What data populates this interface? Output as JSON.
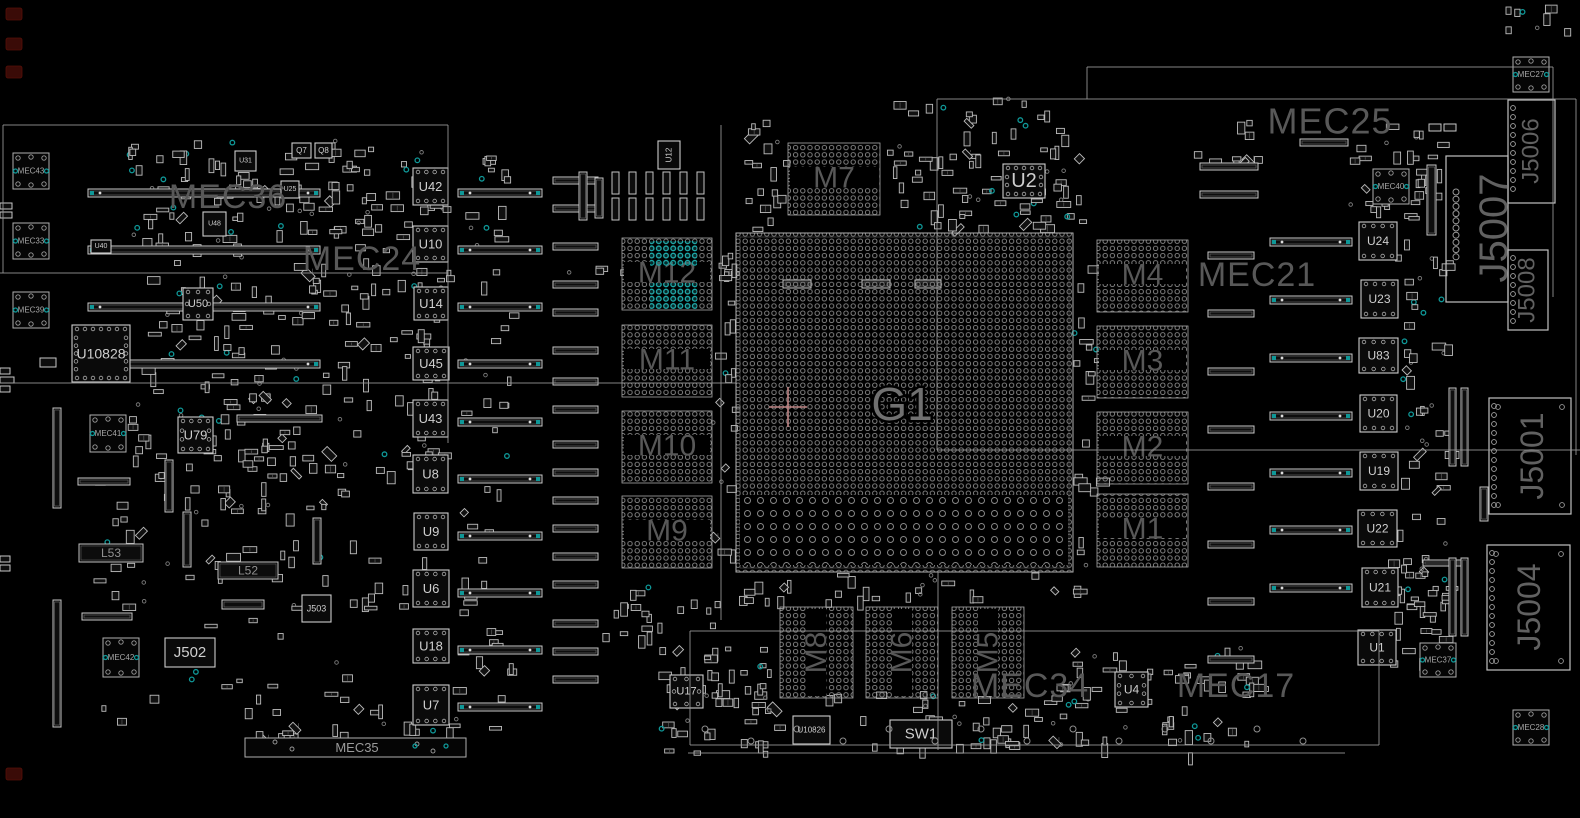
{
  "app": {
    "title": "PCB boardview component placement drawing"
  },
  "board": {
    "width": 1580,
    "height": 818
  },
  "colors": {
    "bg": "#000000",
    "outline": "#9a9a9a",
    "part": "#bdbdbd",
    "part_dim": "#6f6f6f",
    "fill_dark": "#101010",
    "label_big": "#585858",
    "label_g1": "#707070",
    "label_chip": "#cfcfcf",
    "label_fid": "#a8a8a8",
    "teal": "#0f9898",
    "teal_bright": "#14b0b0",
    "pink": "#c08585",
    "hole": "#8f8f8f",
    "maroon": "#3a0b07",
    "dot": "#8c8c8c"
  },
  "region_labels": [
    {
      "text": "MEC36",
      "x": 228,
      "y": 197,
      "size": 34
    },
    {
      "text": "MEC24",
      "x": 362,
      "y": 259,
      "size": 34
    },
    {
      "text": "MEC25",
      "x": 1330,
      "y": 121,
      "size": 36
    },
    {
      "text": "MEC21",
      "x": 1257,
      "y": 275,
      "size": 34
    },
    {
      "text": "MEC17",
      "x": 1236,
      "y": 686,
      "size": 34
    },
    {
      "text": "MEC34",
      "x": 1030,
      "y": 686,
      "size": 34
    }
  ],
  "g1": {
    "label": "G1",
    "x": 736,
    "y": 233,
    "w": 337,
    "h": 339,
    "label_x": 902,
    "label_y": 404,
    "label_size": 46,
    "cross_x": 788,
    "cross_y": 407,
    "sparse": [
      740,
      495,
      328,
      70
    ]
  },
  "memory_blocks": [
    {
      "label": "M12",
      "x": 622,
      "y": 238,
      "w": 90,
      "h": 72
    },
    {
      "label": "M11",
      "x": 622,
      "y": 325,
      "w": 90,
      "h": 72
    },
    {
      "label": "M10",
      "x": 622,
      "y": 411,
      "w": 90,
      "h": 72
    },
    {
      "label": "M9",
      "x": 622,
      "y": 496,
      "w": 90,
      "h": 72
    },
    {
      "label": "M7",
      "x": 788,
      "y": 143,
      "w": 92,
      "h": 72
    },
    {
      "label": "M4",
      "x": 1097,
      "y": 240,
      "w": 91,
      "h": 72
    },
    {
      "label": "M3",
      "x": 1097,
      "y": 326,
      "w": 91,
      "h": 72
    },
    {
      "label": "M2",
      "x": 1097,
      "y": 412,
      "w": 91,
      "h": 72
    },
    {
      "label": "M1",
      "x": 1097,
      "y": 494,
      "w": 91,
      "h": 73
    },
    {
      "label": "M8",
      "x": 780,
      "y": 607,
      "w": 73,
      "h": 91,
      "rot": true
    },
    {
      "label": "M6",
      "x": 866,
      "y": 607,
      "w": 72,
      "h": 91,
      "rot": true
    },
    {
      "label": "M5",
      "x": 952,
      "y": 607,
      "w": 72,
      "h": 91,
      "rot": true
    }
  ],
  "m12_teal_patches": [
    [
      650,
      241,
      47,
      25
    ],
    [
      650,
      283,
      47,
      26
    ]
  ],
  "chips": [
    [
      "U42",
      413,
      168,
      35,
      37,
      "qfn",
      13
    ],
    [
      "U10",
      413,
      226,
      35,
      36,
      "qfn",
      13
    ],
    [
      "U14",
      414,
      287,
      34,
      33,
      "qfn",
      13
    ],
    [
      "U45",
      413,
      347,
      36,
      33,
      "qfn",
      13
    ],
    [
      "U43",
      413,
      400,
      35,
      37,
      "qfn",
      13
    ],
    [
      "U8",
      413,
      455,
      35,
      38,
      "qfn",
      13
    ],
    [
      "U9",
      414,
      513,
      34,
      37,
      "qfn",
      13
    ],
    [
      "U6",
      413,
      570,
      36,
      37,
      "qfn",
      13
    ],
    [
      "U18",
      413,
      629,
      36,
      34,
      "qfn",
      13
    ],
    [
      "U7",
      413,
      685,
      36,
      40,
      "qfn",
      13
    ],
    [
      "U24",
      1359,
      222,
      38,
      38,
      "qfn",
      12
    ],
    [
      "U23",
      1361,
      280,
      37,
      38,
      "qfn",
      12
    ],
    [
      "U83",
      1359,
      338,
      39,
      35,
      "qfn",
      12
    ],
    [
      "U20",
      1360,
      395,
      37,
      37,
      "qfn",
      12
    ],
    [
      "U19",
      1360,
      452,
      38,
      38,
      "qfn",
      12
    ],
    [
      "U22",
      1358,
      510,
      39,
      37,
      "qfn",
      12
    ],
    [
      "U21",
      1362,
      568,
      36,
      39,
      "qfn",
      12
    ],
    [
      "U1",
      1358,
      630,
      38,
      35,
      "qfn",
      12
    ],
    [
      "U10828",
      72,
      325,
      58,
      57,
      "qfn4",
      14
    ],
    [
      "U50",
      183,
      288,
      30,
      32,
      "qfn4",
      11
    ],
    [
      "U79",
      178,
      417,
      35,
      36,
      "qfn4",
      13
    ],
    [
      "U2",
      1003,
      164,
      42,
      34,
      "qfn4",
      20
    ],
    [
      "U17",
      670,
      675,
      33,
      33,
      "qfn4",
      11
    ],
    [
      "U4",
      1115,
      672,
      33,
      35,
      "qfn4",
      12
    ],
    [
      "U12",
      658,
      141,
      22,
      28,
      "box",
      8,
      1
    ],
    [
      "U31",
      235,
      151,
      21,
      20,
      "box",
      7
    ],
    [
      "Q7",
      292,
      143,
      19,
      15,
      "box",
      8
    ],
    [
      "Q8",
      315,
      143,
      17,
      15,
      "box",
      8
    ],
    [
      "U25",
      281,
      181,
      18,
      17,
      "box",
      7
    ],
    [
      "U48",
      203,
      212,
      23,
      24,
      "box",
      7
    ],
    [
      "U40",
      91,
      240,
      20,
      13,
      "box",
      7
    ],
    [
      "U10826",
      793,
      716,
      37,
      28,
      "box",
      8
    ],
    [
      "SW1",
      890,
      720,
      62,
      28,
      "box",
      15
    ],
    [
      "J502",
      165,
      638,
      50,
      29,
      "box",
      15
    ],
    [
      "J503",
      302,
      595,
      29,
      27,
      "box",
      9
    ]
  ],
  "connectors": [
    {
      "label": "J5007",
      "x": 1446,
      "y": 156,
      "w": 62,
      "h": 146,
      "font": 40,
      "lx": 1494,
      "ly": 228,
      "holes": true
    },
    {
      "label": "J5006",
      "x": 1508,
      "y": 100,
      "w": 47,
      "h": 103,
      "font": 24,
      "lx": 1531,
      "ly": 151,
      "bumps": true
    },
    {
      "label": "J5008",
      "x": 1508,
      "y": 250,
      "w": 40,
      "h": 80,
      "font": 24,
      "lx": 1527,
      "ly": 290,
      "bumps": true
    },
    {
      "label": "J5001",
      "x": 1489,
      "y": 398,
      "w": 82,
      "h": 116,
      "font": 32,
      "lx": 1532,
      "ly": 456,
      "bumps": true,
      "corners": true
    },
    {
      "label": "J5004",
      "x": 1487,
      "y": 545,
      "w": 83,
      "h": 125,
      "font": 32,
      "lx": 1529,
      "ly": 607,
      "bumps": true,
      "corners": true
    }
  ],
  "fiducials": [
    [
      "MEC43",
      13,
      153,
      36,
      36
    ],
    [
      "MEC33",
      13,
      223,
      36,
      36
    ],
    [
      "MEC39",
      13,
      292,
      36,
      36
    ],
    [
      "MEC41",
      90,
      415,
      36,
      37
    ],
    [
      "MEC42",
      103,
      638,
      36,
      39
    ],
    [
      "MEC40",
      1373,
      169,
      36,
      35
    ],
    [
      "MEC27",
      1513,
      57,
      36,
      35
    ],
    [
      "MEC37",
      1420,
      643,
      36,
      34
    ],
    [
      "MEC28",
      1513,
      710,
      36,
      35
    ]
  ],
  "mec35_strip": {
    "label": "MEC35",
    "x": 245,
    "y": 738,
    "w": 221,
    "h": 19,
    "label_x": 357
  },
  "labeled_bars": [
    [
      "L53",
      79,
      544,
      64,
      18
    ],
    [
      "L52",
      218,
      562,
      60,
      17
    ]
  ],
  "hslots": [
    [
      88,
      189,
      232,
      8,
      1
    ],
    [
      88,
      246,
      232,
      8,
      1
    ],
    [
      88,
      303,
      232,
      8,
      1
    ],
    [
      88,
      360,
      232,
      8,
      1
    ],
    [
      458,
      189,
      84,
      8,
      1
    ],
    [
      458,
      246,
      84,
      8,
      1
    ],
    [
      458,
      303,
      84,
      8,
      1
    ],
    [
      458,
      360,
      84,
      8,
      1
    ],
    [
      458,
      418,
      84,
      8,
      1
    ],
    [
      458,
      475,
      84,
      8,
      1
    ],
    [
      458,
      532,
      84,
      8,
      1
    ],
    [
      458,
      589,
      84,
      8,
      1
    ],
    [
      458,
      646,
      84,
      8,
      1
    ],
    [
      458,
      703,
      84,
      8,
      1
    ],
    [
      553,
      177,
      45,
      7,
      0
    ],
    [
      553,
      205,
      45,
      7,
      0
    ],
    [
      553,
      243,
      45,
      7,
      0
    ],
    [
      553,
      281,
      45,
      7,
      0
    ],
    [
      553,
      309,
      45,
      7,
      0
    ],
    [
      553,
      347,
      45,
      7,
      0
    ],
    [
      553,
      378,
      45,
      7,
      0
    ],
    [
      553,
      406,
      45,
      7,
      0
    ],
    [
      553,
      441,
      45,
      7,
      0
    ],
    [
      553,
      469,
      45,
      7,
      0
    ],
    [
      553,
      497,
      45,
      7,
      0
    ],
    [
      553,
      525,
      45,
      7,
      0
    ],
    [
      553,
      553,
      45,
      7,
      0
    ],
    [
      553,
      581,
      45,
      7,
      0
    ],
    [
      553,
      620,
      45,
      7,
      0
    ],
    [
      553,
      648,
      45,
      7,
      0
    ],
    [
      553,
      676,
      45,
      7,
      0
    ],
    [
      237,
      415,
      85,
      7,
      0
    ],
    [
      78,
      478,
      52,
      7,
      0
    ],
    [
      222,
      600,
      42,
      9,
      0
    ],
    [
      82,
      613,
      50,
      7,
      0
    ],
    [
      783,
      280,
      28,
      8,
      0
    ],
    [
      862,
      280,
      28,
      8,
      0
    ],
    [
      915,
      280,
      26,
      8,
      0
    ],
    [
      1208,
      252,
      46,
      7,
      0
    ],
    [
      1208,
      310,
      46,
      7,
      0
    ],
    [
      1208,
      368,
      46,
      7,
      0
    ],
    [
      1208,
      426,
      46,
      7,
      0
    ],
    [
      1208,
      483,
      46,
      7,
      0
    ],
    [
      1208,
      541,
      46,
      7,
      0
    ],
    [
      1208,
      598,
      46,
      7,
      0
    ],
    [
      1208,
      656,
      46,
      7,
      0
    ],
    [
      1270,
      238,
      82,
      8,
      1
    ],
    [
      1270,
      296,
      82,
      8,
      1
    ],
    [
      1270,
      354,
      82,
      8,
      1
    ],
    [
      1270,
      412,
      82,
      8,
      1
    ],
    [
      1270,
      469,
      82,
      8,
      1
    ],
    [
      1270,
      526,
      82,
      8,
      1
    ],
    [
      1270,
      584,
      82,
      8,
      1
    ],
    [
      1200,
      163,
      58,
      7,
      0
    ],
    [
      1200,
      191,
      58,
      7,
      0
    ],
    [
      1300,
      139,
      48,
      7,
      0
    ],
    [
      1423,
      560,
      42,
      6,
      0
    ],
    [
      0,
      203,
      12,
      6,
      0
    ],
    [
      0,
      212,
      12,
      6,
      0
    ],
    [
      0,
      368,
      10,
      6,
      0
    ],
    [
      0,
      377,
      14,
      6,
      0
    ],
    [
      0,
      386,
      10,
      6,
      0
    ],
    [
      0,
      556,
      10,
      6,
      0
    ],
    [
      0,
      565,
      10,
      6,
      0
    ],
    [
      40,
      358,
      16,
      9,
      0
    ],
    [
      1429,
      124,
      12,
      7,
      0
    ],
    [
      1444,
      124,
      12,
      7,
      0
    ]
  ],
  "vslots": [
    [
      53,
      408,
      8,
      100
    ],
    [
      53,
      600,
      8,
      127
    ],
    [
      165,
      460,
      8,
      52
    ],
    [
      183,
      512,
      8,
      55
    ],
    [
      313,
      518,
      8,
      46
    ],
    [
      1427,
      165,
      9,
      70
    ],
    [
      1449,
      388,
      7,
      78
    ],
    [
      1461,
      388,
      7,
      78
    ],
    [
      1449,
      558,
      7,
      78
    ],
    [
      1461,
      558,
      7,
      78
    ],
    [
      1480,
      487,
      8,
      34
    ],
    [
      612,
      172,
      7,
      22
    ],
    [
      629,
      172,
      7,
      22
    ],
    [
      646,
      172,
      7,
      22
    ],
    [
      663,
      172,
      7,
      22
    ],
    [
      680,
      172,
      7,
      22
    ],
    [
      697,
      172,
      7,
      22
    ],
    [
      612,
      198,
      7,
      22
    ],
    [
      629,
      198,
      7,
      22
    ],
    [
      646,
      198,
      7,
      22
    ],
    [
      663,
      198,
      7,
      22
    ],
    [
      680,
      198,
      7,
      22
    ],
    [
      697,
      198,
      7,
      22
    ],
    [
      579,
      172,
      8,
      48
    ],
    [
      595,
      178,
      8,
      40
    ]
  ],
  "lines": [
    [
      3,
      125,
      448,
      125
    ],
    [
      3,
      125,
      3,
      273
    ],
    [
      0,
      273,
      448,
      273
    ],
    [
      448,
      125,
      448,
      443
    ],
    [
      0,
      383,
      736,
      383
    ],
    [
      721,
      125,
      721,
      620
    ],
    [
      937,
      99,
      1576,
      99
    ],
    [
      937,
      99,
      937,
      450
    ],
    [
      937,
      450,
      1580,
      450
    ],
    [
      1087,
      67,
      1553,
      67
    ],
    [
      1553,
      67,
      1553,
      297
    ],
    [
      1087,
      67,
      1087,
      99
    ],
    [
      1576,
      99,
      1576,
      455
    ],
    [
      938,
      572,
      938,
      750
    ],
    [
      690,
      631,
      1379,
      631
    ],
    [
      690,
      631,
      690,
      745
    ],
    [
      690,
      745,
      1379,
      745
    ],
    [
      1379,
      631,
      1379,
      745
    ],
    [
      688,
      753,
      1345,
      753
    ]
  ],
  "clusters": [
    [
      128,
      140,
      322,
      335,
      300,
      11
    ],
    [
      95,
      478,
      255,
      55,
      28,
      12
    ],
    [
      90,
      535,
      360,
      195,
      55,
      13
    ],
    [
      884,
      98,
      196,
      132,
      85,
      14
    ],
    [
      742,
      118,
      44,
      112,
      18,
      15
    ],
    [
      565,
      262,
      175,
      12,
      12,
      16
    ],
    [
      712,
      236,
      24,
      338,
      22,
      17
    ],
    [
      1073,
      236,
      24,
      338,
      22,
      18
    ],
    [
      735,
      573,
      340,
      28,
      28,
      19
    ],
    [
      655,
      645,
      120,
      108,
      55,
      20
    ],
    [
      820,
      688,
      245,
      62,
      40,
      21
    ],
    [
      1050,
      648,
      215,
      105,
      65,
      22
    ],
    [
      1395,
      150,
      52,
      520,
      70,
      23
    ],
    [
      1335,
      118,
      108,
      92,
      26,
      24
    ],
    [
      1385,
      555,
      58,
      125,
      22,
      25
    ],
    [
      452,
      150,
      58,
      580,
      55,
      26
    ],
    [
      600,
      586,
      120,
      55,
      20,
      27
    ],
    [
      245,
      700,
      205,
      35,
      18,
      28
    ],
    [
      1500,
      5,
      70,
      28,
      8,
      29
    ],
    [
      1180,
      120,
      80,
      45,
      10,
      31
    ]
  ],
  "holes_row": {
    "x0": 705,
    "step": 46,
    "count": 14,
    "y_even": 729,
    "y_odd": 741
  },
  "corner_marks": [
    [
      6,
      8,
      16,
      12
    ],
    [
      6,
      38,
      16,
      12
    ],
    [
      6,
      66,
      16,
      12
    ],
    [
      6,
      768,
      16,
      12
    ]
  ]
}
